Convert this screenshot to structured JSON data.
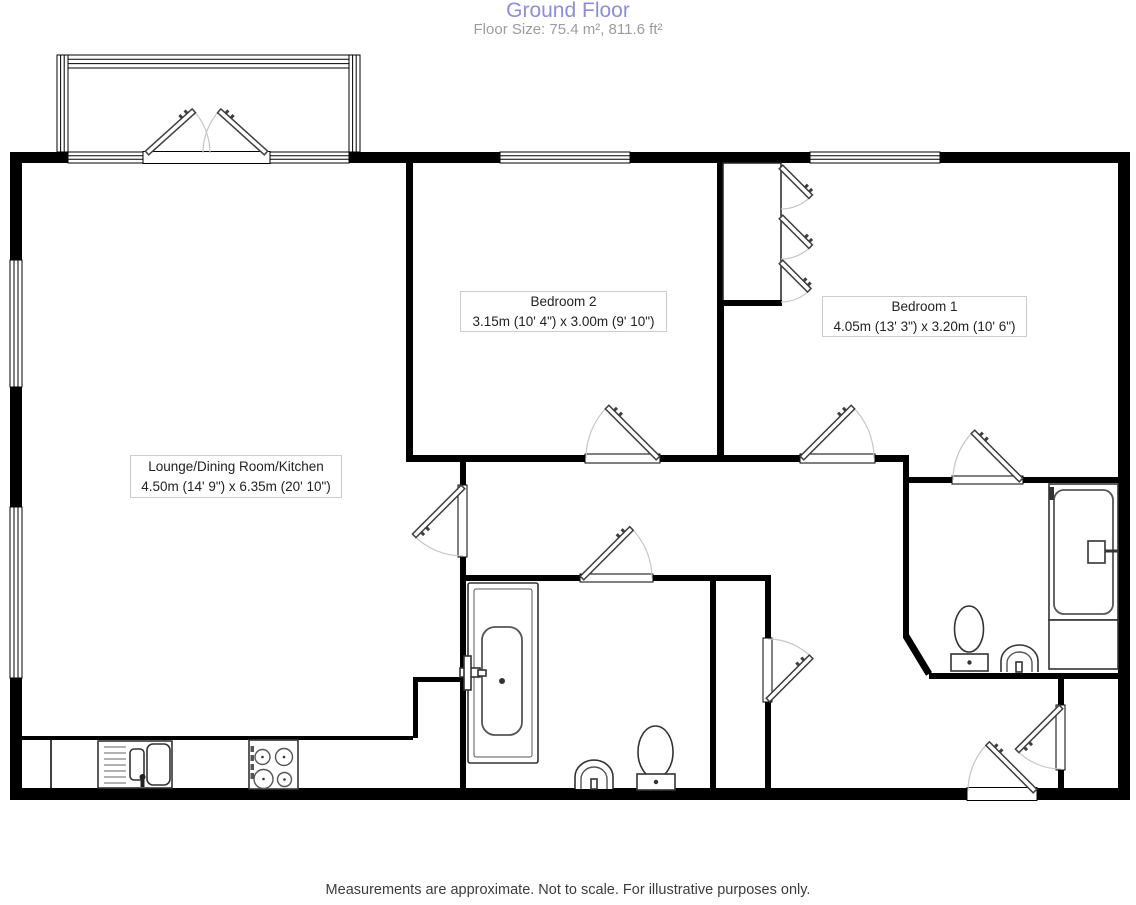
{
  "header": {
    "title": "Ground Floor",
    "subtitle": "Floor Size: 75.4 m², 811.6 ft²"
  },
  "rooms": [
    {
      "name": "Lounge/Dining Room/Kitchen",
      "dimensions": "4.50m (14' 9\") x 6.35m (20' 10\")"
    },
    {
      "name": "Bedroom 2",
      "dimensions": "3.15m (10' 4\") x 3.00m (9' 10\")"
    },
    {
      "name": "Bedroom 1",
      "dimensions": "4.05m (13' 3\") x 3.20m (10' 6\")"
    }
  ],
  "footer": {
    "disclaimer": "Measurements are approximate. Not to scale. For illustrative purposes only."
  },
  "colors": {
    "title_text": "#8e8ed6",
    "subtitle_text": "#9c9c9c",
    "footer_text": "#3c3c3c",
    "wall": "#000000",
    "door_arc": "#c6c6c6",
    "label_border": "#cccccc",
    "background": "#ffffff"
  }
}
